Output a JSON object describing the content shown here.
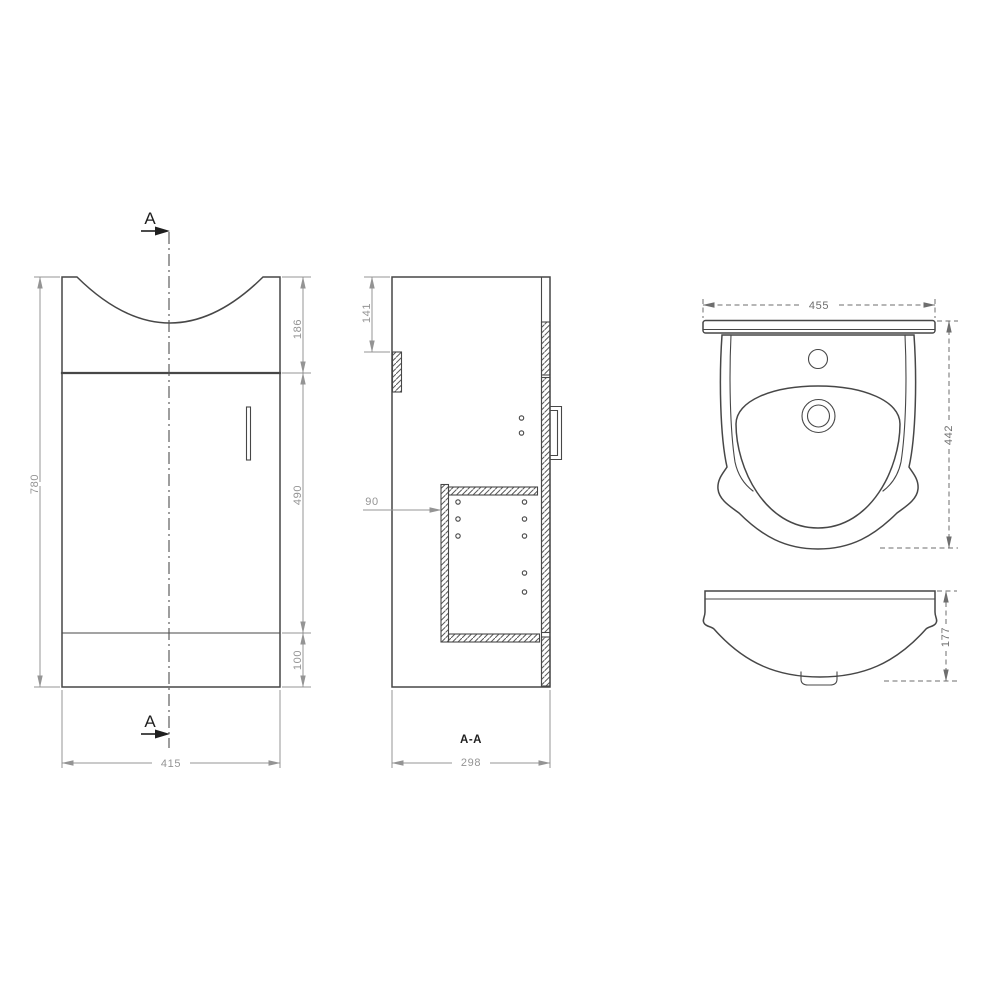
{
  "drawing": {
    "type": "technical-orthographic-drawing",
    "subject": "vanity-unit-with-basin",
    "colors": {
      "object_line": "#474747",
      "dimension_line": "#949494",
      "dimension_dark": "#6e6e6e",
      "annotation": "#1f1f1f",
      "hatch": "#5a5a5a",
      "background": "#ffffff"
    },
    "front_view": {
      "section_marker_top": "A",
      "section_marker_bottom": "A",
      "dim_overall_height": "780",
      "dim_basin_recess": "186",
      "dim_door": "490",
      "dim_plinth": "100",
      "dim_overall_width": "415"
    },
    "section_view": {
      "section_title": "A-A",
      "dim_rail_offset": "141",
      "dim_shelf_inset": "90",
      "dim_overall_depth": "298"
    },
    "basin_plan_view": {
      "dim_width": "455",
      "dim_depth": "442"
    },
    "basin_front_view": {
      "dim_height": "177"
    }
  }
}
